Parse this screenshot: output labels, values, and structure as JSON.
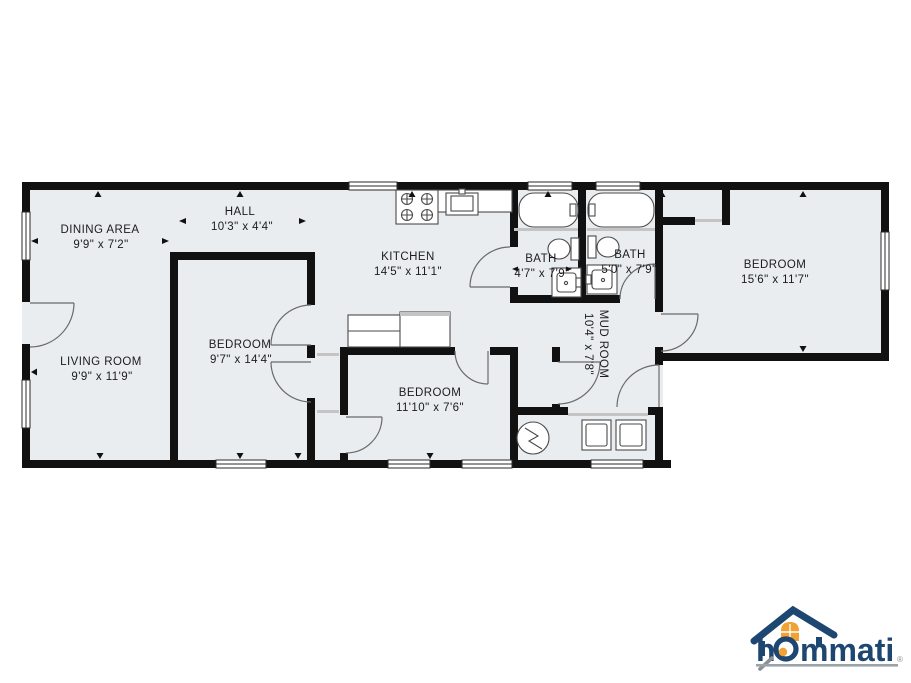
{
  "plan": {
    "rooms": [
      {
        "name": "DINING AREA",
        "dims": "9'9\" x 7'2\""
      },
      {
        "name": "HALL",
        "dims": "10'3\" x 4'4\""
      },
      {
        "name": "KITCHEN",
        "dims": "14'5\" x 11'1\""
      },
      {
        "name": "BATH",
        "dims": "4'7\" x 7'9\""
      },
      {
        "name": "BATH",
        "dims": "5'0\" x 7'9\""
      },
      {
        "name": "BEDROOM",
        "dims": "15'6\" x 11'7\""
      },
      {
        "name": "LIVING ROOM",
        "dims": "9'9\" x 11'9\""
      },
      {
        "name": "BEDROOM",
        "dims": "9'7\" x 14'4\""
      },
      {
        "name": "BEDROOM",
        "dims": "11'10\" x 7'6\""
      },
      {
        "name": "MUD ROOM",
        "dims": "10'4\" x 7'8\""
      }
    ],
    "colors": {
      "floor": "#e9edf0",
      "wall": "#111111"
    }
  },
  "logo": {
    "text_h": "h",
    "text_rest": "mmati",
    "registered": "®",
    "colors": {
      "navy": "#1d4670",
      "orange": "#f2a133",
      "underline": "#9aa3a8"
    }
  }
}
